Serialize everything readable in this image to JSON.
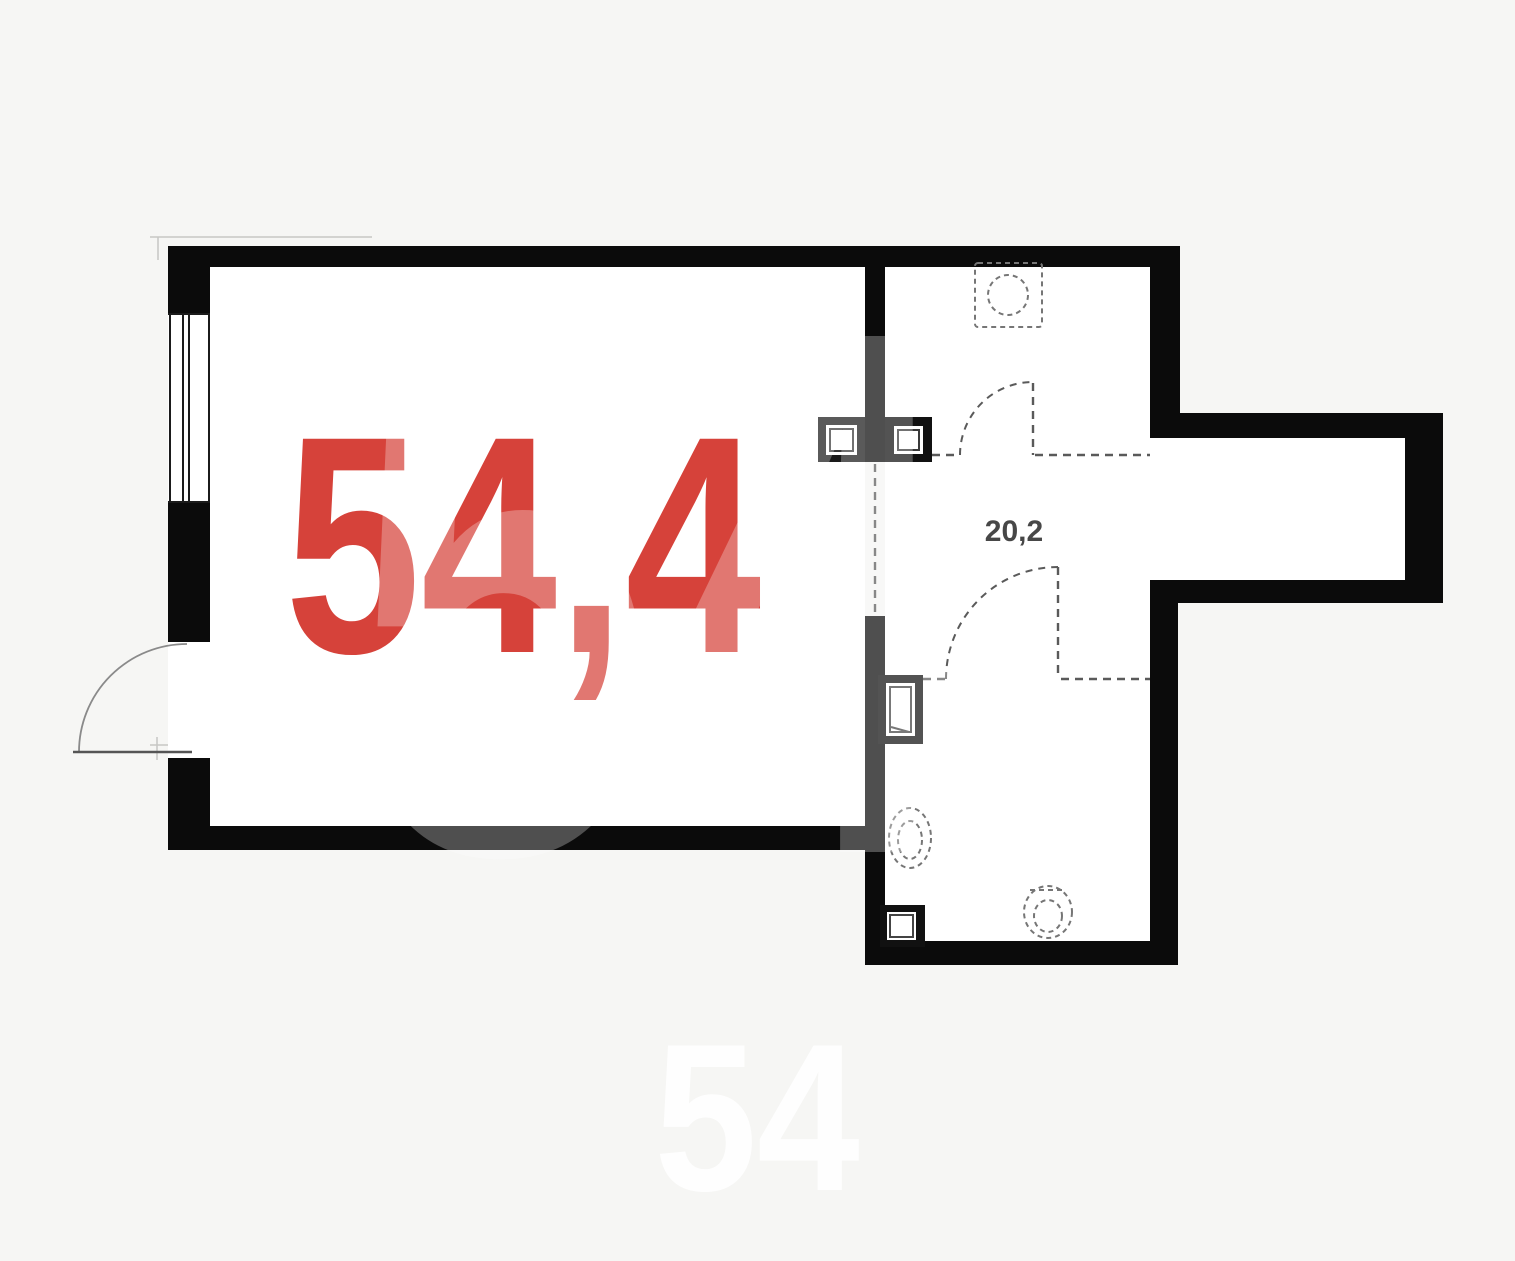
{
  "page": {
    "background_color": "#f6f6f4"
  },
  "floorplan": {
    "main_room": {
      "area_label": "54,4",
      "area_color": "#d6423a"
    },
    "secondary_room": {
      "area_label": "20,2",
      "area_color": "#474747"
    },
    "watermarks": {
      "center": "54",
      "bottom": "54",
      "color": "#ffffff"
    },
    "colors": {
      "wall": "#0b0b0b",
      "interior": "#ffffff",
      "window_line": "#1b1b1b",
      "door_swing": "#8a8a8a",
      "dashed_partition": "#5a5a5a",
      "fixture_dashed": "#767676"
    },
    "icons": {
      "window": "double-line-in-wall-opening",
      "entry_door": "quarter-arc-swing",
      "interior_door_upper": "dashed-quarter-arc-swing",
      "interior_door_lower": "dashed-quarter-arc-swing",
      "washing_machine": "dashed-square-with-circle",
      "sink": "dashed-oval",
      "toilet": "dashed-oval-with-tank",
      "electrical_panel_left": "nested-squares",
      "electrical_panel_right": "nested-squares",
      "utility_box_mid": "nested-rects",
      "utility_box_bottom": "nested-squares"
    }
  }
}
